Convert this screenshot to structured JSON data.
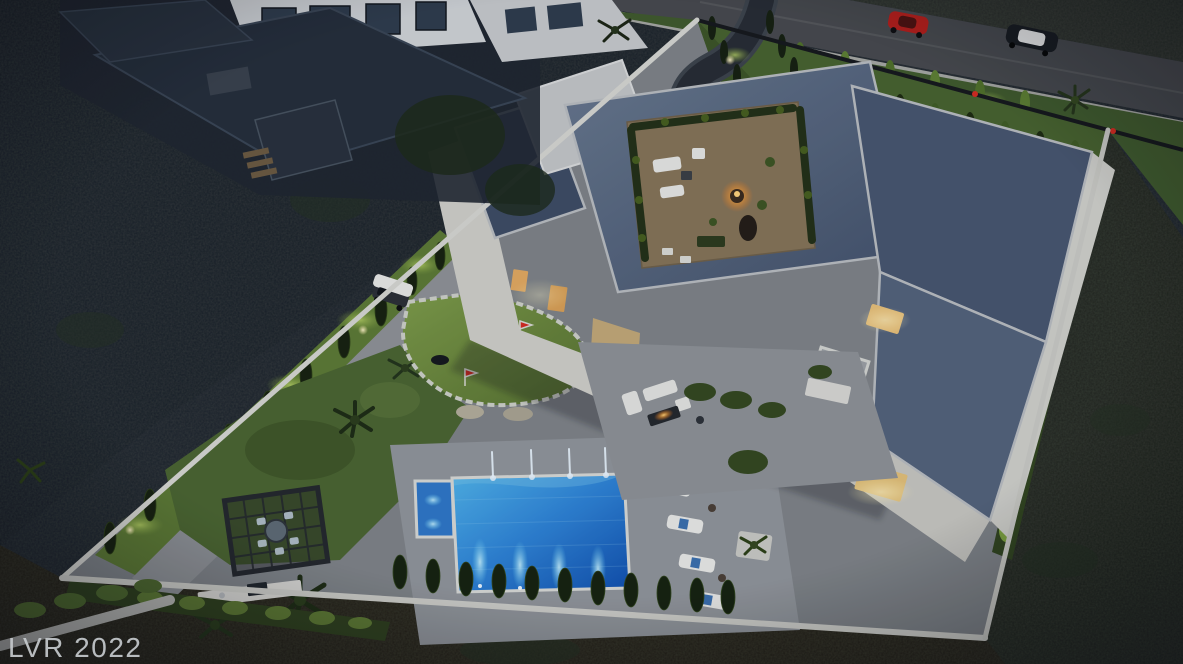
{
  "scene": {
    "description": "Dusk aerial 3D rendering of a walled modern luxury estate on a dark hillside",
    "time_of_day": "dusk",
    "view": "aerial"
  },
  "watermark": {
    "text": "LVR 2022",
    "color": "#c6cacd"
  },
  "palette": {
    "hillside_dark": "#1a212a",
    "hillside_brown": "#2521170",
    "hillside_green": "#20261f",
    "road": "#46494d",
    "sidewalk": "#a5a7a2",
    "wall": "#d6d7d1",
    "paving": "#7e8387",
    "paving_light": "#90959a",
    "roof_main": "#5a6a80",
    "roof_dark": "#46556e",
    "roof_mid": "#52627a",
    "deck_wood": "#857457",
    "lawn": "#46622e",
    "lawn_road": "#3f5a2c",
    "lawn_lit": "#a6c455",
    "putting_green": "#6d8c3e",
    "pool_deep": "#0f4fae",
    "pool_mid": "#2f86d8",
    "pool_light": "#4fb4ea",
    "tree_dark": "#16210e",
    "hedge": "#2e401d",
    "uplight": "#fff6c9",
    "window_glow": "#e2a95f",
    "fire_glow": "#ff9e30",
    "flag_red": "#d42b20",
    "car_red": "#b51f1a",
    "car_dark": "#171b20",
    "car_roof_white": "#e6e8e8"
  },
  "counts": {
    "pool_fountain_jets": 4,
    "pool_floor_jets": 4,
    "pool_loungers": 4,
    "putting_green_flags": 4,
    "cars_on_road": 2
  }
}
